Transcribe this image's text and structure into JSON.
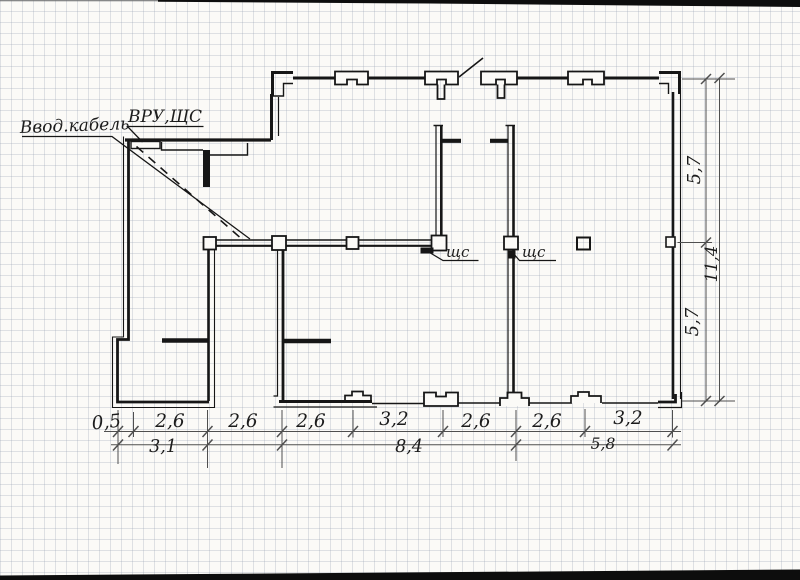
{
  "document": {
    "kind": "Hand-drawn electrical floor plan sketch on graph paper",
    "language": "ru"
  },
  "labels": {
    "cable_entry": "Ввод.кабель",
    "main_panel": "ВРУ,ЩС",
    "panel_left": "щс",
    "panel_right": "щс"
  },
  "dims": {
    "bottom_row1": [
      "0,5",
      "2,6",
      "2,6",
      "2,6",
      "3,2",
      "2,6",
      "2,6",
      "3,2"
    ],
    "bottom_row2": [
      "3,1",
      "8,4",
      "5,8"
    ],
    "right_col": [
      "5,7",
      "11,4",
      "5,7"
    ]
  },
  "colors": {
    "paper": "#fbfaf7",
    "grid_line": "#9aa4b5",
    "ink": "#161616",
    "pencil": "#4f4f4f",
    "scan_band": "#0d0d0d"
  }
}
